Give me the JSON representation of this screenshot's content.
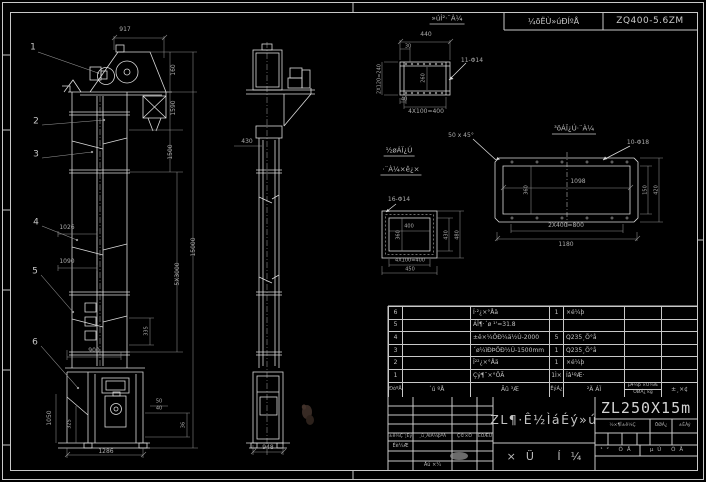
{
  "header": {
    "tech_label": "¼õËÙ»úÐÍºÅ",
    "model": "ZQ400-5.6ZM"
  },
  "labels": [
    {
      "t": "1",
      "x": 33,
      "y": 48,
      "cls": "callout"
    },
    {
      "t": "2",
      "x": 36,
      "y": 122,
      "cls": "callout"
    },
    {
      "t": "3",
      "x": 36,
      "y": 155,
      "cls": "callout"
    },
    {
      "t": "4",
      "x": 36,
      "y": 223,
      "cls": "callout"
    },
    {
      "t": "5",
      "x": 35,
      "y": 272,
      "cls": "callout"
    },
    {
      "t": "6",
      "x": 35,
      "y": 343,
      "cls": "callout"
    },
    {
      "t": "917",
      "x": 125,
      "y": 30
    },
    {
      "t": "160",
      "x": 174,
      "y": 70,
      "r": 1
    },
    {
      "t": "1590",
      "x": 174,
      "y": 108,
      "r": 1
    },
    {
      "t": "1500",
      "x": 171,
      "y": 152,
      "r": 1
    },
    {
      "t": "5X3000",
      "x": 178,
      "y": 274,
      "r": 1
    },
    {
      "t": "15000",
      "x": 194,
      "y": 247,
      "r": 1
    },
    {
      "t": "1026",
      "x": 67,
      "y": 228
    },
    {
      "t": "1090",
      "x": 67,
      "y": 262
    },
    {
      "t": "335",
      "x": 147,
      "y": 331,
      "r": 1,
      "fs": 5
    },
    {
      "t": "900",
      "x": 94,
      "y": 351
    },
    {
      "t": "1050",
      "x": 50,
      "y": 418,
      "r": 1
    },
    {
      "t": "325",
      "x": 70,
      "y": 424,
      "r": 1,
      "fs": 5
    },
    {
      "t": "1286",
      "x": 106,
      "y": 452
    },
    {
      "t": "50",
      "x": 159,
      "y": 402,
      "fs": 5
    },
    {
      "t": "40",
      "x": 159,
      "y": 409,
      "fs": 5
    },
    {
      "t": "36",
      "x": 184,
      "y": 425,
      "r": 1,
      "fs": 5
    },
    {
      "t": "430",
      "x": 247,
      "y": 142,
      "fs": 6
    },
    {
      "t": "948",
      "x": 268,
      "y": 448,
      "fs": 6
    },
    {
      "t": "»úÍ²·¨À¼",
      "x": 447,
      "y": 20,
      "cls": "u",
      "fs": 7
    },
    {
      "t": "440",
      "x": 426,
      "y": 35
    },
    {
      "t": "30",
      "x": 408,
      "y": 47,
      "fs": 5
    },
    {
      "t": "2X120=240",
      "x": 380,
      "y": 79,
      "r": 1,
      "fs": 5
    },
    {
      "t": "260",
      "x": 424,
      "y": 78,
      "r": 1,
      "fs": 5
    },
    {
      "t": "11-Φ14",
      "x": 472,
      "y": 61
    },
    {
      "t": "40",
      "x": 404,
      "y": 100,
      "fs": 5
    },
    {
      "t": "4X100=400",
      "x": 426,
      "y": 112,
      "fs": 6
    },
    {
      "t": "³öÁÏ¿Ú·¨À¼",
      "x": 574,
      "y": 130,
      "cls": "u",
      "fs": 7
    },
    {
      "t": "50 x 45°",
      "x": 461,
      "y": 136
    },
    {
      "t": "10-Φ18",
      "x": 638,
      "y": 143
    },
    {
      "t": "1098",
      "x": 578,
      "y": 182
    },
    {
      "t": "360",
      "x": 527,
      "y": 190,
      "r": 1,
      "fs": 5
    },
    {
      "t": "150",
      "x": 646,
      "y": 190,
      "r": 1,
      "fs": 5
    },
    {
      "t": "420",
      "x": 657,
      "y": 190,
      "r": 1,
      "fs": 5
    },
    {
      "t": "2X400=800",
      "x": 566,
      "y": 226,
      "fs": 6
    },
    {
      "t": "1180",
      "x": 566,
      "y": 245
    },
    {
      "t": "½øÁÏ¿Ú",
      "x": 399,
      "y": 152,
      "cls": "u",
      "fs": 7
    },
    {
      "t": "·¨À¼×ê¿×",
      "x": 401,
      "y": 171,
      "cls": "u",
      "fs": 7
    },
    {
      "t": "16-Φ14",
      "x": 399,
      "y": 200,
      "fs": 6
    },
    {
      "t": "400",
      "x": 409,
      "y": 227,
      "fs": 5
    },
    {
      "t": "360",
      "x": 399,
      "y": 235,
      "r": 1,
      "fs": 5
    },
    {
      "t": "430",
      "x": 447,
      "y": 235,
      "r": 1,
      "fs": 5
    },
    {
      "t": "480",
      "x": 458,
      "y": 235,
      "r": 1,
      "fs": 5
    },
    {
      "t": "4X100=400",
      "x": 410,
      "y": 261,
      "fs": 5
    },
    {
      "t": "450",
      "x": 410,
      "y": 270,
      "fs": 5
    }
  ],
  "bom": {
    "header": {
      "seq": "ÐòºÅ",
      "code": "´ú ºÅ",
      "name": "Ãû ³Æ",
      "qty": "ÊýÁ¿",
      "material": "²Ä ÁÏ",
      "weight_top": "µ¥¼þ ×Ü¼Æ",
      "weight_bottom": "ÖØÁ¿ kg",
      "remark": "±¸×¢"
    },
    "rows": [
      {
        "seq": "6",
        "code": "",
        "name": "Í·²¿×°Åä",
        "qty": "1",
        "material": "×é¼þ",
        "weight": "",
        "remark": ""
      },
      {
        "seq": "5",
        "code": "",
        "name": "ÁÏ¶·´ø ¹'=31.8",
        "qty": "",
        "material": "",
        "weight": "",
        "remark": ""
      },
      {
        "seq": "4",
        "code": "",
        "name": "±ê×¼ÖÐ¼ä½Ú-2000",
        "qty": "5",
        "material": "Q235¸Ö°å",
        "weight": "",
        "remark": ""
      },
      {
        "seq": "3",
        "code": "",
        "name": "´ø¼ìÐÞÖÐ½Ú-1500mm",
        "qty": "1",
        "material": "Q235¸Ö°å",
        "weight": "",
        "remark": ""
      },
      {
        "seq": "2",
        "code": "",
        "name": "Î²²¿×°Åä",
        "qty": "1",
        "material": "×é¼þ",
        "weight": "",
        "remark": ""
      },
      {
        "seq": "1",
        "code": "",
        "name": "Çý¶¯×°ÖÃ",
        "qty": "1Ì×",
        "material": "Íâ¹ºÆ·",
        "weight": "",
        "remark": ""
      }
    ]
  },
  "titleblock": {
    "big_title": "ZL¶·Ê½ÌáÉý»ú",
    "subtitle": "×Ü Í¼",
    "model": "ZL250X15m",
    "rev_headers": [
      "±ê¼Ç´¦Êý",
      "¸ü¸ÄÎÄ¼þºÅ",
      "Ç©×Ö",
      "ÈÕÆÚ"
    ],
    "design_label": "Éè¼Æ",
    "approve_label": "Åú ×¼",
    "stage_label": "½×¶Î±ê¼Ç",
    "weight_label": "ÖØÁ¿",
    "scale_label": "±ÈÀý",
    "sheet_total": "¹² ÕÅ",
    "sheet_no": "µÚ ÕÅ"
  }
}
